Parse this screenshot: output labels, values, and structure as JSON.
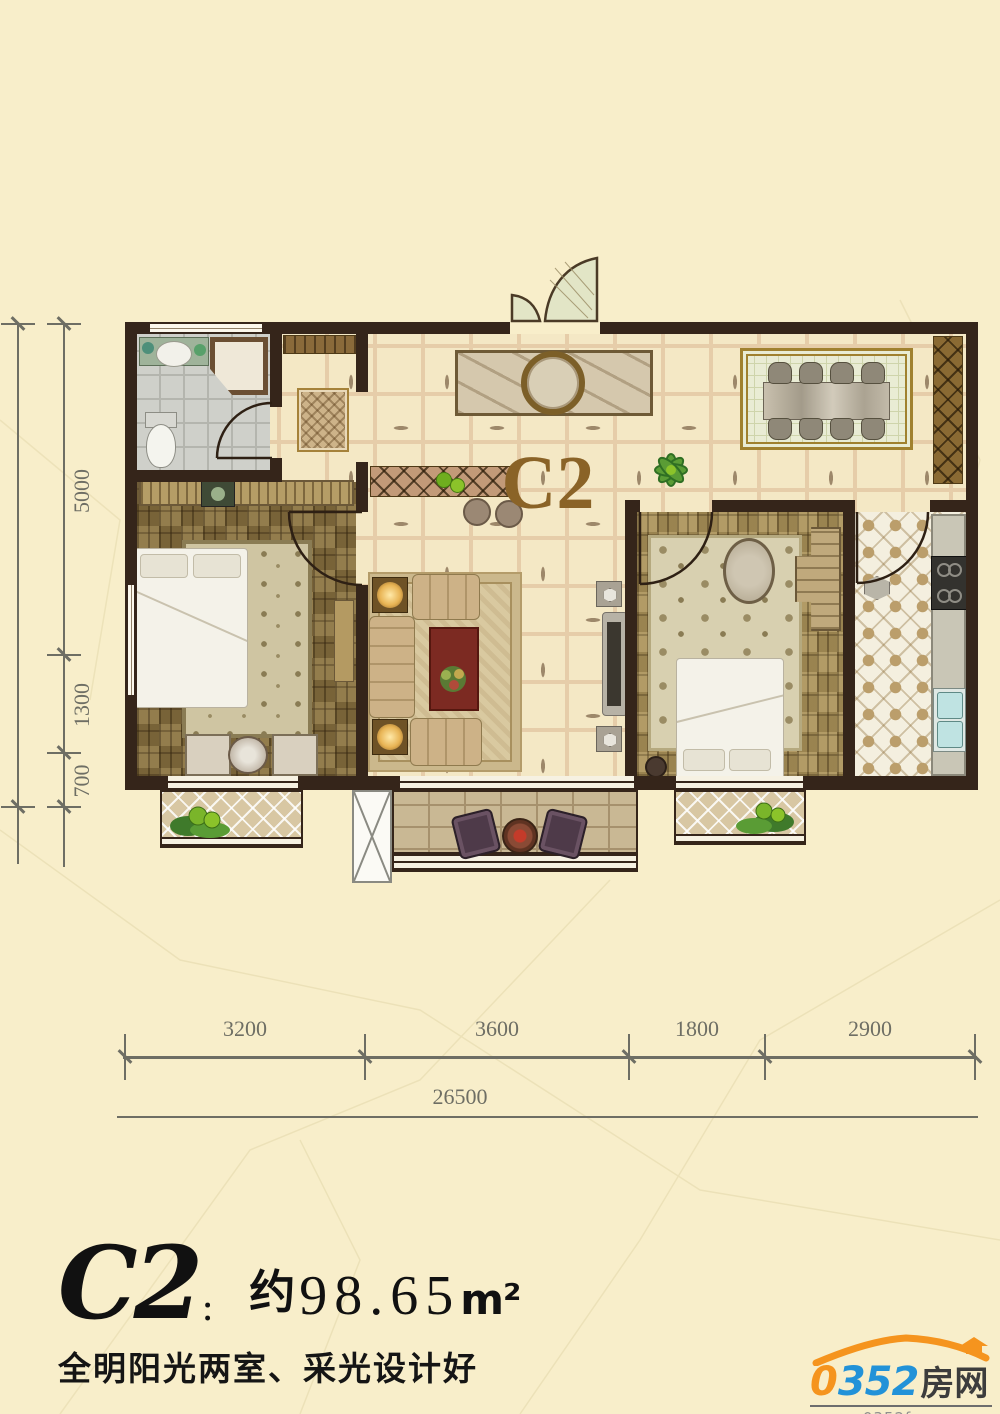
{
  "plan": {
    "unit_label": "C2"
  },
  "dimensions": {
    "left": [
      "5000",
      "1300",
      "700"
    ],
    "bottom": [
      "3200",
      "3600",
      "1800",
      "2900"
    ],
    "total": "26500"
  },
  "title": {
    "code": "C2",
    "colon": "：",
    "approx": "约",
    "value": "98.65",
    "unit": "m²"
  },
  "subtitle": "全明阳光两室、采光设计好",
  "logo": {
    "brand_prefix": "0",
    "brand_digits": "352",
    "brand_suffix": "房网",
    "website": "www.0352fang.com"
  },
  "colors": {
    "background": "#f8eeca",
    "wall": "#35251a",
    "unit_label_brown": "#8a6327",
    "dimension_gray": "#6e6e64",
    "logo_blue": "#2292d8",
    "logo_orange": "#f5941e"
  }
}
